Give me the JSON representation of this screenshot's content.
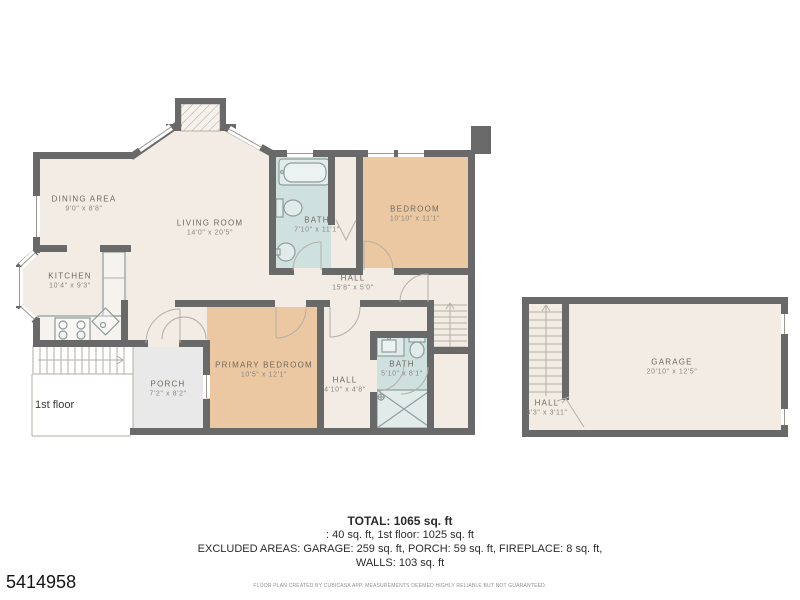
{
  "floor_label": "1st floor",
  "photo_id": "5414958",
  "rooms": [
    {
      "name": "DINING AREA",
      "dims": "9'0\" x 8'8\""
    },
    {
      "name": "LIVING ROOM",
      "dims": "14'0\" x 20'5\""
    },
    {
      "name": "KITCHEN",
      "dims": "10'4\" x 9'3\""
    },
    {
      "name": "BATH",
      "dims": "7'10\" x 11'1\""
    },
    {
      "name": "BEDROOM",
      "dims": "10'10\" x 11'1\""
    },
    {
      "name": "HALL",
      "dims": "15'8\" x 5'0\""
    },
    {
      "name": "PRIMARY BEDROOM",
      "dims": "10'5\" x 12'1\""
    },
    {
      "name": "HALL",
      "dims": "4'10\" x 4'8\""
    },
    {
      "name": "BATH",
      "dims": "5'10\" x 8'1\""
    },
    {
      "name": "PORCH",
      "dims": "7'2\" x 8'2\""
    },
    {
      "name": "GARAGE",
      "dims": "20'10\" x 12'5\""
    },
    {
      "name": "HALL",
      "dims": "3'3\" x 3'11\""
    }
  ],
  "summary": {
    "total": "TOTAL: 1065 sq. ft",
    "line2": ": 40 sq. ft, 1st floor: 1025 sq. ft",
    "line3": "EXCLUDED AREAS: GARAGE: 259 sq. ft, PORCH: 59 sq. ft, FIREPLACE: 8 sq. ft,",
    "line4": "WALLS: 103 sq. ft",
    "disclaimer": "FLOOR PLAN CREATED BY CUBICASA APP. MEASUREMENTS DEEMED HIGHLY RELIABLE BUT NOT GUARANTEED."
  },
  "icons": {
    "stairs_direction_arrow": "up",
    "deck_direction_arrow": "right"
  },
  "colors": {
    "wall": "#696969",
    "floor": "#f2ece4",
    "bedroom": "#ebc8a2",
    "bath": "#cfe1df",
    "porch": "#e9e9e9",
    "line": "#b3aea6",
    "fixture": "#8c9d9b",
    "labeltext": "#6e6960",
    "dimtext": "#8a857c",
    "summarytext": "#2b2b2b",
    "disclaimertext": "#8f8f8f",
    "idtext": "#141414"
  }
}
